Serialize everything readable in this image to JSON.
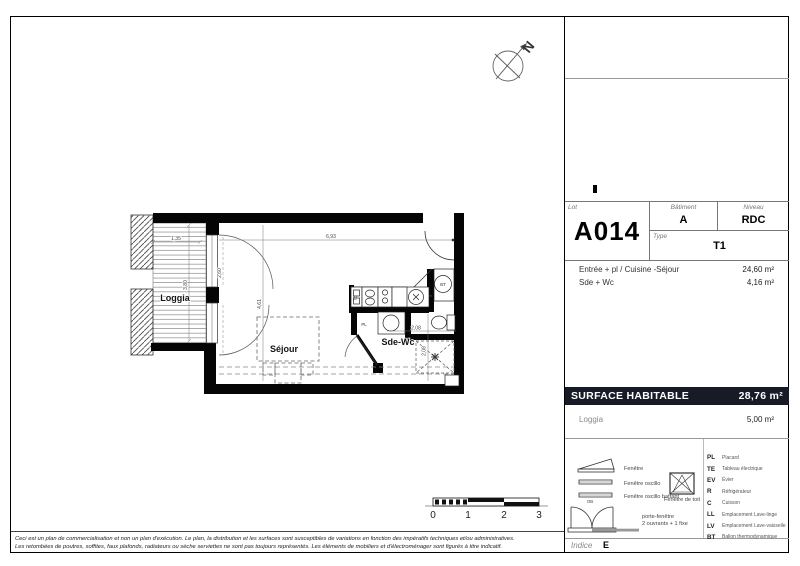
{
  "title_block": {
    "lot_label": "Lot",
    "lot": "A014",
    "batiment_label": "Bâtiment",
    "batiment": "A",
    "niveau_label": "Niveau",
    "niveau": "RDC",
    "type_label": "Type",
    "type": "T1"
  },
  "areas": {
    "rows": [
      {
        "label": "Entrée + pl / Cuisine -Séjour",
        "value": "24,60 m²"
      },
      {
        "label": "Sde + Wc",
        "value": "4,16 m²"
      }
    ]
  },
  "surface": {
    "label": "SURFACE HABITABLE",
    "value": "28,76 m²"
  },
  "loggia_row": {
    "label": "Loggia",
    "value": "5,00 m²"
  },
  "legend": {
    "windows": [
      {
        "label": "Fenêtre"
      },
      {
        "label": "Fenêtre oscillo"
      },
      {
        "label": "Fenêtre oscillo battant",
        "tag": "OB"
      }
    ],
    "roof_window": "Fenêtre de toit",
    "porte_fenetre": {
      "line1": "porte-fenêtre",
      "line2": "2 ouvrants + 1 fixe"
    },
    "abbreviations": [
      {
        "code": "PL",
        "label": "Placard"
      },
      {
        "code": "TE",
        "label": "Tableau électrique"
      },
      {
        "code": "EV",
        "label": "Évier"
      },
      {
        "code": "R",
        "label": "Réfrigérateur"
      },
      {
        "code": "C",
        "label": "Cuisson"
      },
      {
        "code": "LL",
        "label": "Emplacement Lave-linge"
      },
      {
        "code": "LV",
        "label": "Emplacement Lave-vaisselle"
      },
      {
        "code": "BT",
        "label": "Ballon thermodynamique"
      }
    ]
  },
  "indice": {
    "label": "Indice",
    "value": "E"
  },
  "plan": {
    "rooms": {
      "loggia": "Loggia",
      "sejour": "Séjour",
      "sde_wc": "Sde-Wc"
    },
    "fixtures": {
      "pl": "PL",
      "bt": "BT",
      "te": "TE"
    },
    "dimensions": {
      "loggia_width": "1,35",
      "loggia_height": "3,80",
      "main_width": "6,93",
      "main_height": "4,61",
      "sdewc_width": "2,08",
      "sdewc_height": "2,08",
      "window_width": "2,60"
    },
    "compass_letter": "N"
  },
  "scale_bar": {
    "labels": [
      "0",
      "1",
      "2",
      "3"
    ]
  },
  "disclaimer": {
    "line1": "Ceci est un plan de commercialisation et non un plan d'exécution. Le plan, la distribution et les surfaces sont susceptibles de variations en fonction des impératifs techniques et/ou administratives.",
    "line2": "Les retombées de poutres, soffites, faux plafonds, radiateurs ou sèche serviettes ne sont pas toujours représentés. Les éléments de mobiliers et d'électroménager sont figurés à titre indicatif."
  },
  "colors": {
    "surface_bar_bg": "#171b26",
    "wall": "#000000",
    "deck_line": "#888888"
  }
}
